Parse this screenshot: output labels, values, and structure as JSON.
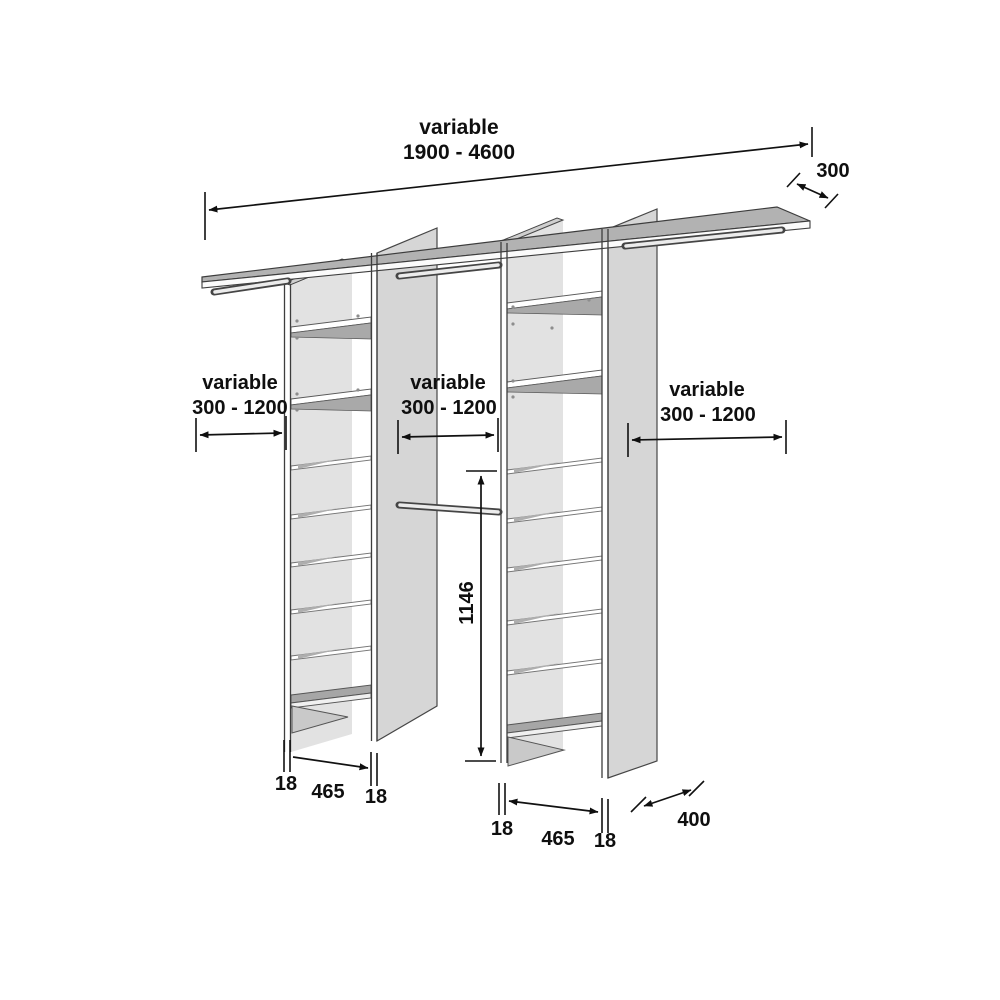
{
  "dimensions": {
    "top_width": {
      "line1": "variable",
      "line2": "1900 - 4600"
    },
    "shelf_depth": "300",
    "gap_left": {
      "line1": "variable",
      "line2": "300 - 1200"
    },
    "gap_middle": {
      "line1": "variable",
      "line2": "300 - 1200"
    },
    "gap_right": {
      "line1": "variable",
      "line2": "300 - 1200"
    },
    "tower_height": "1146",
    "tower_left_bottom": {
      "panel_left": "18",
      "inner_width": "465",
      "panel_right": "18"
    },
    "tower_right_bottom": {
      "panel_left": "18",
      "inner_width": "465",
      "panel_right": "18"
    },
    "tower_depth": "400"
  },
  "colors": {
    "line": "#111111",
    "panel": "#d6d6d6",
    "shelf_top": "#b2b2b2",
    "background": "#ffffff"
  }
}
